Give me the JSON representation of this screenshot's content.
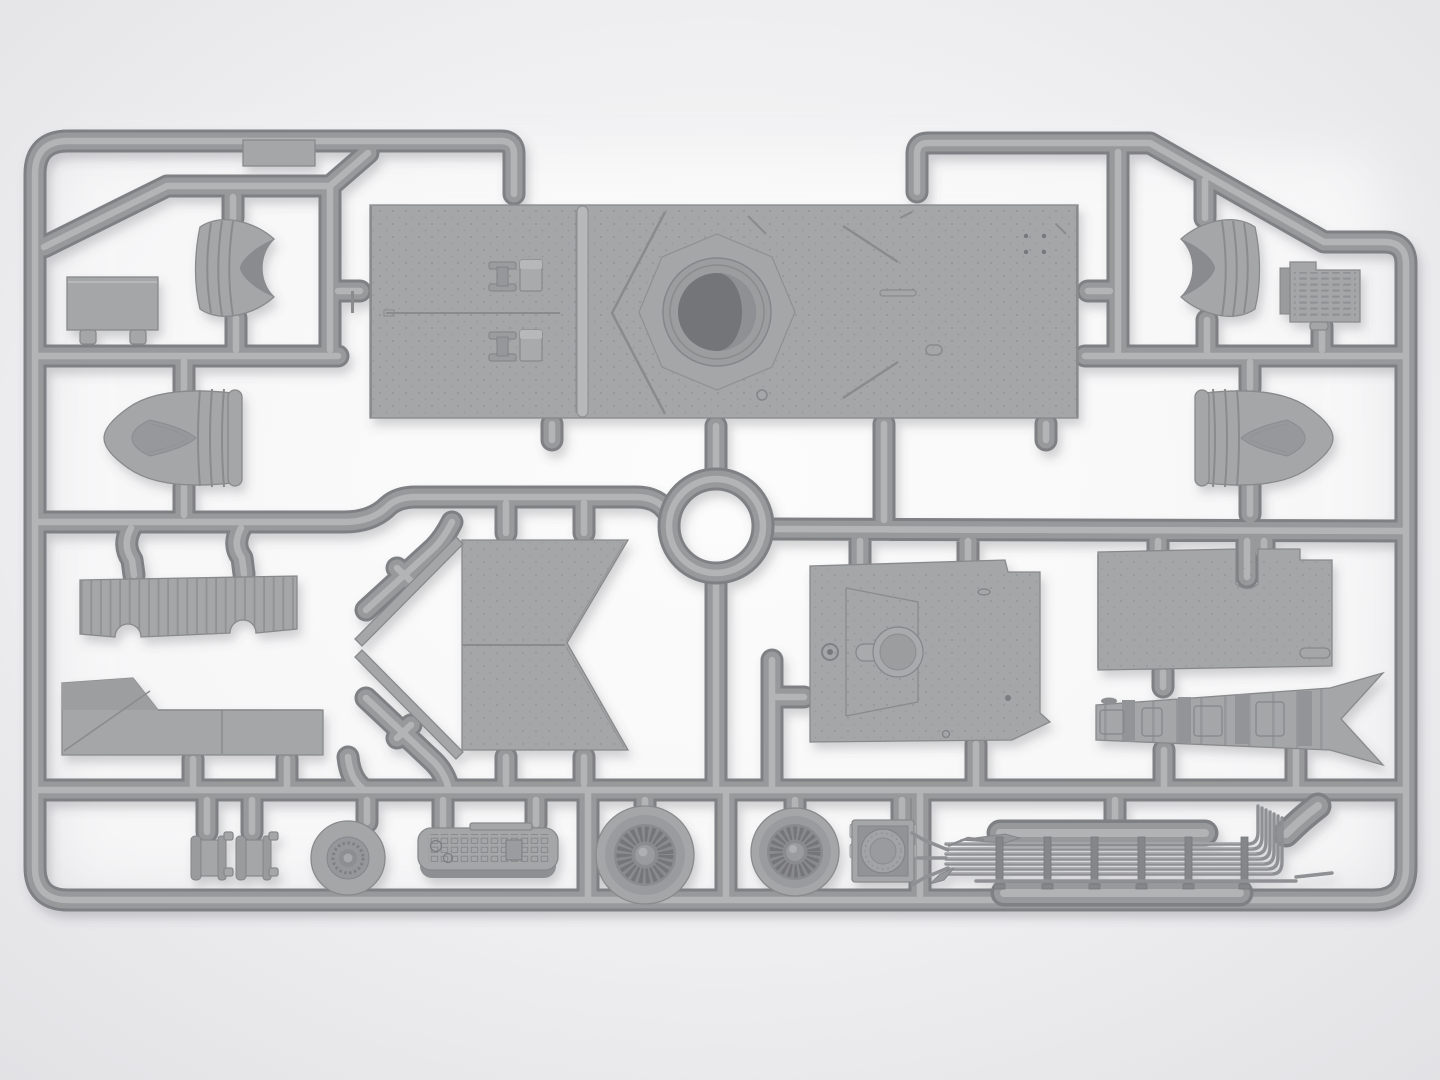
{
  "scene": {
    "description": "Gray injection-molded plastic model kit sprue with armored-vehicle parts on a light studio background"
  },
  "palette": {
    "bg-inner": "#fafafa",
    "bg-mid": "#efeff1",
    "bg-outer": "#e2e2e5",
    "runner-edge": "#7f8083",
    "runner": "#98999b",
    "runner-hi": "#b6b7b9",
    "part": "#a5a6a8",
    "part-dark": "#88898b",
    "part-darker": "#747578",
    "part-light": "#b7b8ba",
    "recess": "#8a8b8e",
    "line": "#8a8b8d"
  },
  "parts": {
    "frame": "sprue runner frame",
    "hull_roof_panel": "hull roof panel with turret ring",
    "turret_ring": "turret ring opening",
    "cowl_left": "left curved cowl part",
    "cowl_right": "right curved cowl part",
    "stowage_box_left": "left stowage box part",
    "engine_block_right": "right louvered block part",
    "dome_left": "left domed cowling part",
    "dome_right": "right domed cowling part",
    "grille_panel": "slatted grille panel",
    "fender_panel": "angular fender panel",
    "chevron_panel": "large chevron deck panel",
    "chevron_strips": "thin chevron edge strips",
    "floor_panel": "riveted floor panel",
    "side_panel": "large side panel",
    "tapered_hull_strip": "striped tapered hull strip",
    "drum_small_1": "small drum part",
    "drum_small_2": "small drum part",
    "hub_wheel": "hub wheel part",
    "instrument_panel": "instrument panel part",
    "fan_wheel_large": "large fan wheel part",
    "fan_wheel_small": "small fan wheel part",
    "hatch_block": "square hatch block part",
    "pipe_bundle": "long pipe bundle assembly",
    "ring_runner": "circular runner ring",
    "gate_label": "sprue gate"
  }
}
